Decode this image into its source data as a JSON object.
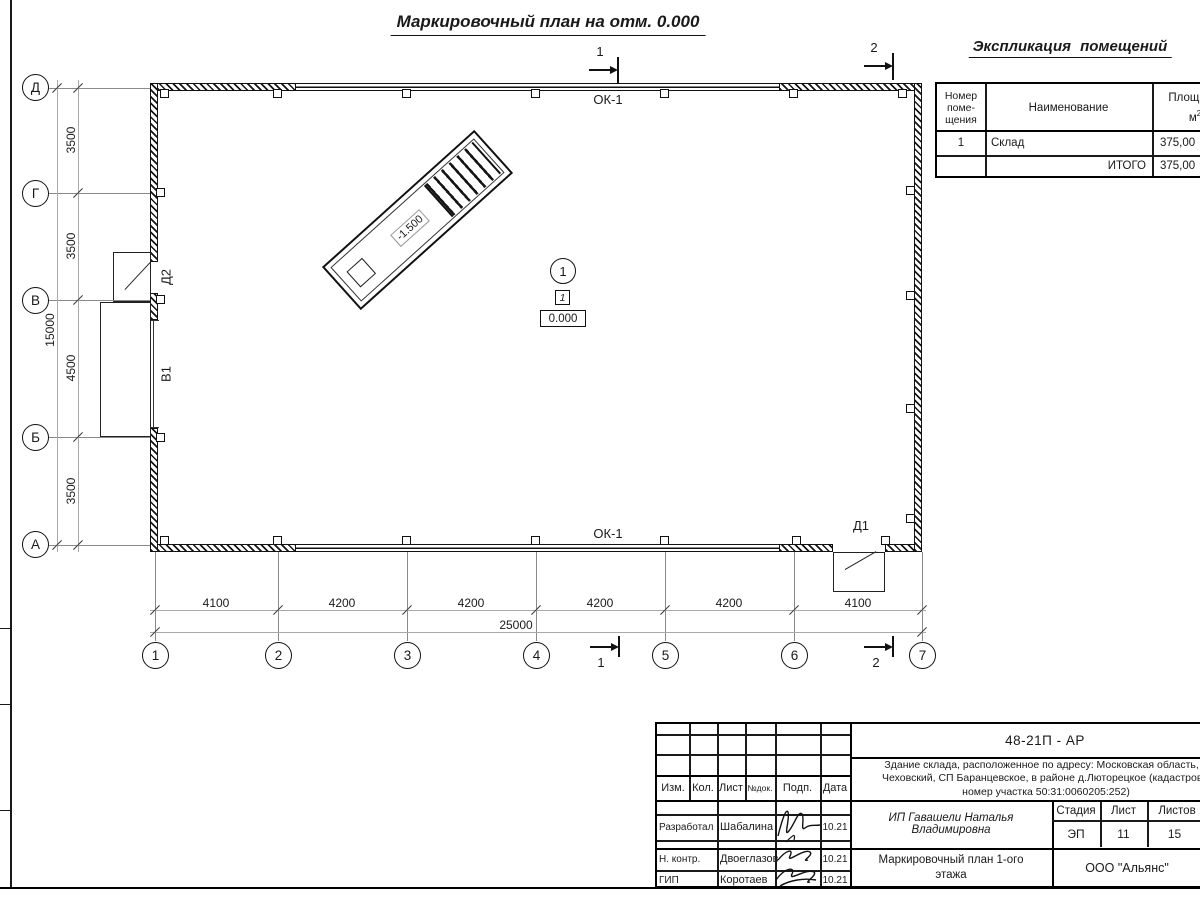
{
  "page": {
    "title": "Маркировочный план на отм. 0.000"
  },
  "plan": {
    "window_label_top": "ОК-1",
    "window_label_bottom": "ОК-1",
    "door1_label": "Д1",
    "door2_label": "Д2",
    "gate_label": "В1",
    "ramp_level": "-1.500",
    "room_number": "1",
    "floor_type_mark": "1",
    "level_mark": "0.000"
  },
  "sections": {
    "s1": "1",
    "s2": "2"
  },
  "axes": {
    "letters": [
      "Д",
      "Г",
      "В",
      "Б",
      "А"
    ],
    "numbers": [
      "1",
      "2",
      "3",
      "4",
      "5",
      "6",
      "7"
    ]
  },
  "dims": {
    "v_segments": [
      "3500",
      "3500",
      "4500",
      "3500"
    ],
    "v_total": "15000",
    "h_segments": [
      "4100",
      "4200",
      "4200",
      "4200",
      "4200",
      "4100"
    ],
    "h_total": "25000"
  },
  "explication": {
    "title": "Экспликация помещений",
    "header": {
      "number_l1": "Номер",
      "number_l2": "поме-",
      "number_l3": "щения",
      "name": "Наименование",
      "area_l1": "Площадь,",
      "area_unit": "м",
      "area_sup": "2"
    },
    "rows": [
      {
        "num": "1",
        "name": "Склад",
        "area": "375,00"
      },
      {
        "num": "",
        "name": "ИТОГО",
        "area": "375,00"
      }
    ]
  },
  "titleblock": {
    "doc_code": "48-21П - АР",
    "address_l1": "Здание склада, расположенное по адресу: Московская область, р",
    "address_l2": "Чеховский, СП Баранцевское, в районе д.Люторецкое  (кадастровы",
    "address_l3": "номер участка 50:31:0060205:252)",
    "cols": {
      "izm": "Изм.",
      "kol": "Кол.",
      "list": "Лист",
      "ndok": "№док.",
      "podp": "Подп.",
      "data": "Дата"
    },
    "staff": [
      {
        "role": "Разработал",
        "name": "Шабалина",
        "date": "10.21"
      },
      {
        "role": "Н. контр.",
        "name": "Двоеглазов",
        "date": "10.21"
      },
      {
        "role": "ГИП",
        "name": "Коротаев",
        "date": "10.21"
      }
    ],
    "client": "ИП Гавашели Наталья Владимировна",
    "stage_label": "Стадия",
    "sheet_label": "Лист",
    "sheets_label": "Листов",
    "stage": "ЭП",
    "sheet_no": "11",
    "sheets_total": "15",
    "sheet_title_l1": "Маркировочный план 1-ого",
    "sheet_title_l2": "этажа",
    "company": "ООО \"Альянс\""
  }
}
